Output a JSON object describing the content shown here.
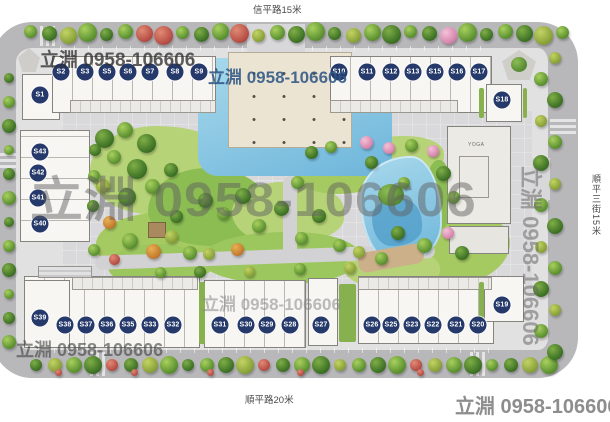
{
  "plan": {
    "streets": {
      "top": "信平路15米",
      "bottom": "順平路20米",
      "right": "順平三街15米"
    },
    "units": [
      "S1",
      "S2",
      "S3",
      "S5",
      "S6",
      "S7",
      "S8",
      "S9",
      "S10",
      "S11",
      "S12",
      "S13",
      "S15",
      "S16",
      "S17",
      "S18",
      "S19",
      "S20",
      "S21",
      "S22",
      "S23",
      "S25",
      "S26",
      "S27",
      "S28",
      "S29",
      "S30",
      "S31",
      "S32",
      "S33",
      "S35",
      "S36",
      "S37",
      "S38",
      "S39",
      "S40",
      "S41",
      "S42",
      "S43"
    ],
    "clubhouse": {
      "room_label": "YOGA"
    },
    "watermarks": {
      "brand": "立淵",
      "phone": "0958-106606",
      "instances": [
        {
          "id": "top-left",
          "text": "立淵 0958-106606"
        },
        {
          "id": "top-center",
          "text": "立淵 0958-106606"
        },
        {
          "id": "center-large",
          "text": "立淵 0958-106606"
        },
        {
          "id": "mid-bottom",
          "text": "立淵 0958-106606"
        },
        {
          "id": "bottom-left",
          "text": "立淵 0958-106606"
        },
        {
          "id": "bottom-right",
          "text": "立淵 0958-106606"
        },
        {
          "id": "right-vertical",
          "text": "立淵 0958-106606"
        }
      ]
    },
    "colors": {
      "badge": "#25396b",
      "road": "#b8b7ba",
      "water": "#6db5da",
      "lawn": "#a6ca62",
      "plaza": "#ece4d2",
      "watermark_blue": "#2f5685",
      "watermark_gray": "#8d8d8d"
    }
  }
}
